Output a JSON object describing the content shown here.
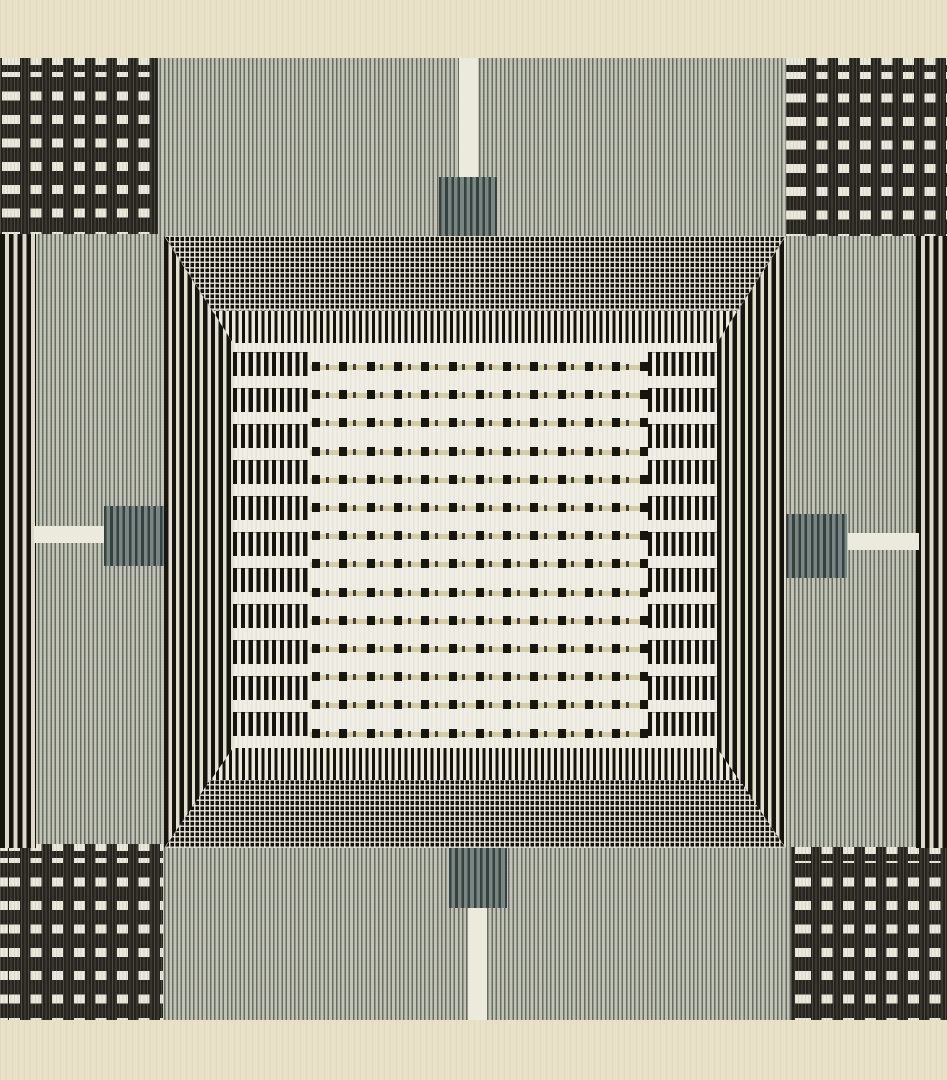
{
  "artwork": {
    "type": "woven-textile-panel",
    "description": "Geometric handwoven tapestry: cream mat, sage warp-striped field, four dark corner blocks with white dash grids, black-and-white selvage stripe bands, a mitered mesh-and-comb frame, slate tabs at the four midpoints, and a central white field with ladder bars and rows of black dashes",
    "colors": {
      "cream": "#e9e1c7",
      "field": "#b3b6a9",
      "ink": "#17150f",
      "white": "#eceadd",
      "tab": "#5d6b68",
      "tan": "rgba(205,195,150,0.78)"
    }
  },
  "pattern": {
    "corner_blocks": {
      "dash_columns": 7,
      "dash_rows": 7
    },
    "center": {
      "dash_rows": 14,
      "row_pitch": 28.2,
      "row_start": 19,
      "dash_cols": 13,
      "col_pitch": 27.3,
      "col_start": 2,
      "bar_count": 11,
      "bar_pitch": 36,
      "bar_start": 9,
      "bar_height": 24
    }
  }
}
